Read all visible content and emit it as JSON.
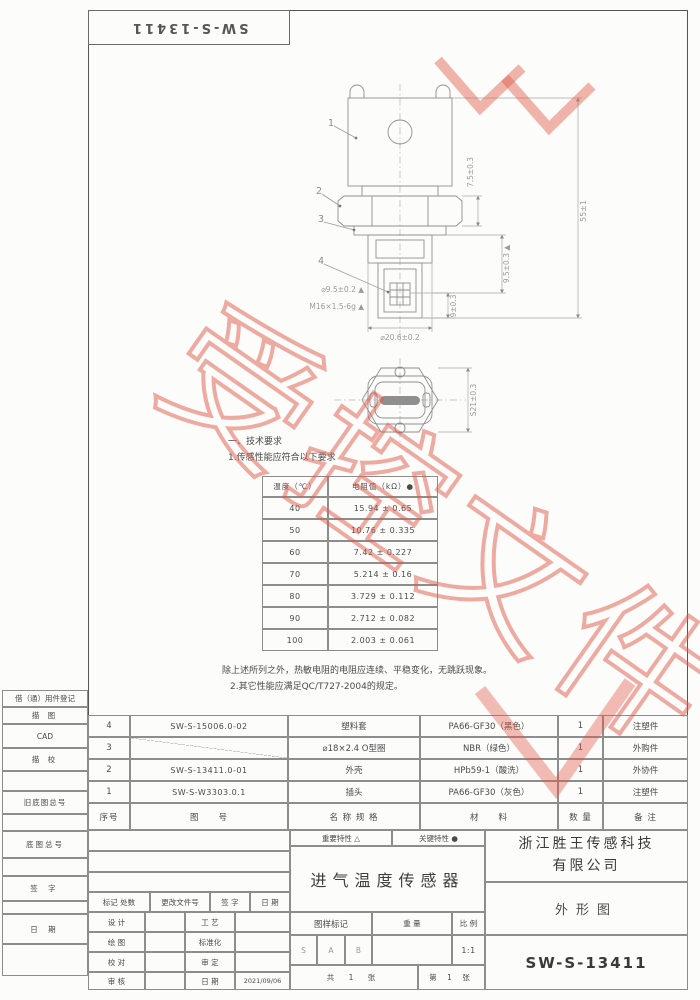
{
  "watermark": {
    "text": "受控文件"
  },
  "corner": {
    "code": "SW-S-13411"
  },
  "tech": {
    "heading": "一、技术要求",
    "item1": "1.传感性能应符合以下要求",
    "note1": "除上述所列之外，热敏电阻的电阻应连续、平稳变化，无跳跃现象。",
    "note2": "2.其它性能应满足QC/T727-2004的规定。"
  },
  "res_table": {
    "headers": [
      "温度（℃）",
      "电阻值（kΩ）●"
    ],
    "rows": [
      [
        "40",
        "15.94 ± 0.65"
      ],
      [
        "50",
        "10.76 ± 0.335"
      ],
      [
        "60",
        "7.42 ± 0.227"
      ],
      [
        "70",
        "5.214 ± 0.16"
      ],
      [
        "80",
        "3.729 ± 0.112"
      ],
      [
        "90",
        "2.712 ± 0.082"
      ],
      [
        "100",
        "2.003 ± 0.061"
      ]
    ]
  },
  "drawing": {
    "balloons": [
      "1",
      "2",
      "3",
      "4"
    ],
    "dims": {
      "height": "55±1",
      "collar": "7.5±0.3",
      "thread_len": "9.5±0.3 ▲",
      "tip_len": "9±0.3",
      "tip_dia": "⌀9.5±0.2 ▲",
      "thread": "M16×1.5-6g ▲",
      "body_dia": "⌀20.6±0.2",
      "hex": "S21±0.3"
    }
  },
  "bom": {
    "headers": [
      "序号",
      "图　　号",
      "名 称 规 格",
      "材　　料",
      "数 量",
      "备 注"
    ],
    "rows": [
      [
        "4",
        "SW-S-15006.0-02",
        "塑料套",
        "PA66-GF30（黑色）",
        "1",
        "注塑件"
      ],
      [
        "3",
        "",
        "⌀18×2.4 O型圈",
        "NBR（绿色）",
        "1",
        "外购件"
      ],
      [
        "2",
        "SW-S-13411.0-01",
        "外壳",
        "HPb59-1（酸洗）",
        "1",
        "外协件"
      ],
      [
        "1",
        "SW-S-W3303.0.1",
        "插头",
        "PA66-GF30（灰色）",
        "1",
        "注塑件"
      ]
    ]
  },
  "titleblock": {
    "company_line1": "浙江胜王传感科技",
    "company_line2": "有限公司",
    "product": "进气温度传感器",
    "view": "外形图",
    "number": "SW-S-13411",
    "attr_important": "重要特性 △",
    "attr_key": "关键特性 ●",
    "mark": "图样标记",
    "weight": "重 量",
    "scale": "比 例",
    "scale_value": "1:1",
    "stages": [
      "S",
      "A",
      "B"
    ],
    "sheet_total": "共 1 张",
    "sheet_index": "第 1 张",
    "rev_headers": [
      "标记 处数",
      "更改文件号",
      "签 字",
      "日 期"
    ],
    "sig": {
      "design": "设 计",
      "craft": "工 艺",
      "draw": "绘 图",
      "standard": "标准化",
      "check": "校 对",
      "approve": "审 定",
      "audit": "审 核",
      "date": "日 期",
      "date_value": "2021/09/06"
    }
  },
  "margin": {
    "blocks": [
      "借（通）用件登记",
      "描 图",
      "CAD",
      "描 校",
      "旧底图总号",
      "底图总号",
      "签 字",
      "日 期"
    ]
  }
}
